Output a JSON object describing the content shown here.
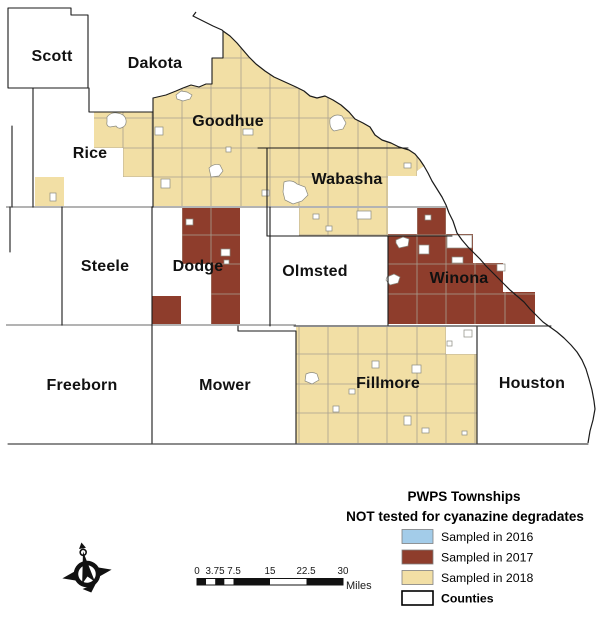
{
  "legend": {
    "title_line1": "PWPS Townships",
    "title_line2": "NOT tested for cyanazine degradates",
    "items": [
      {
        "label": "Sampled in 2016",
        "color": "#A3CCE9"
      },
      {
        "label": "Sampled in 2017",
        "color": "#8E3D2C"
      },
      {
        "label": "Sampled in 2018",
        "color": "#F2DFA5"
      },
      {
        "label": "Counties",
        "color": "#FFFFFF"
      }
    ]
  },
  "scalebar": {
    "ticks": [
      "0",
      "3.75",
      "7.5",
      "15",
      "22.5",
      "30"
    ],
    "unit": "Miles"
  },
  "counties": [
    {
      "name": "Scott"
    },
    {
      "name": "Dakota"
    },
    {
      "name": "Rice"
    },
    {
      "name": "Goodhue"
    },
    {
      "name": "Wabasha"
    },
    {
      "name": "Steele"
    },
    {
      "name": "Dodge"
    },
    {
      "name": "Olmsted"
    },
    {
      "name": "Winona"
    },
    {
      "name": "Freeborn"
    },
    {
      "name": "Mower"
    },
    {
      "name": "Fillmore"
    },
    {
      "name": "Houston"
    }
  ],
  "colors": {
    "sampled_2016": "#A3CCE9",
    "sampled_2017": "#8E3D2C",
    "sampled_2018": "#F2DFA5",
    "counties_fill": "#FFFFFF",
    "county_border": "#1A1A1A",
    "township_grid": "#A9A090"
  },
  "icons": {
    "north_arrow": "compass-rose"
  }
}
